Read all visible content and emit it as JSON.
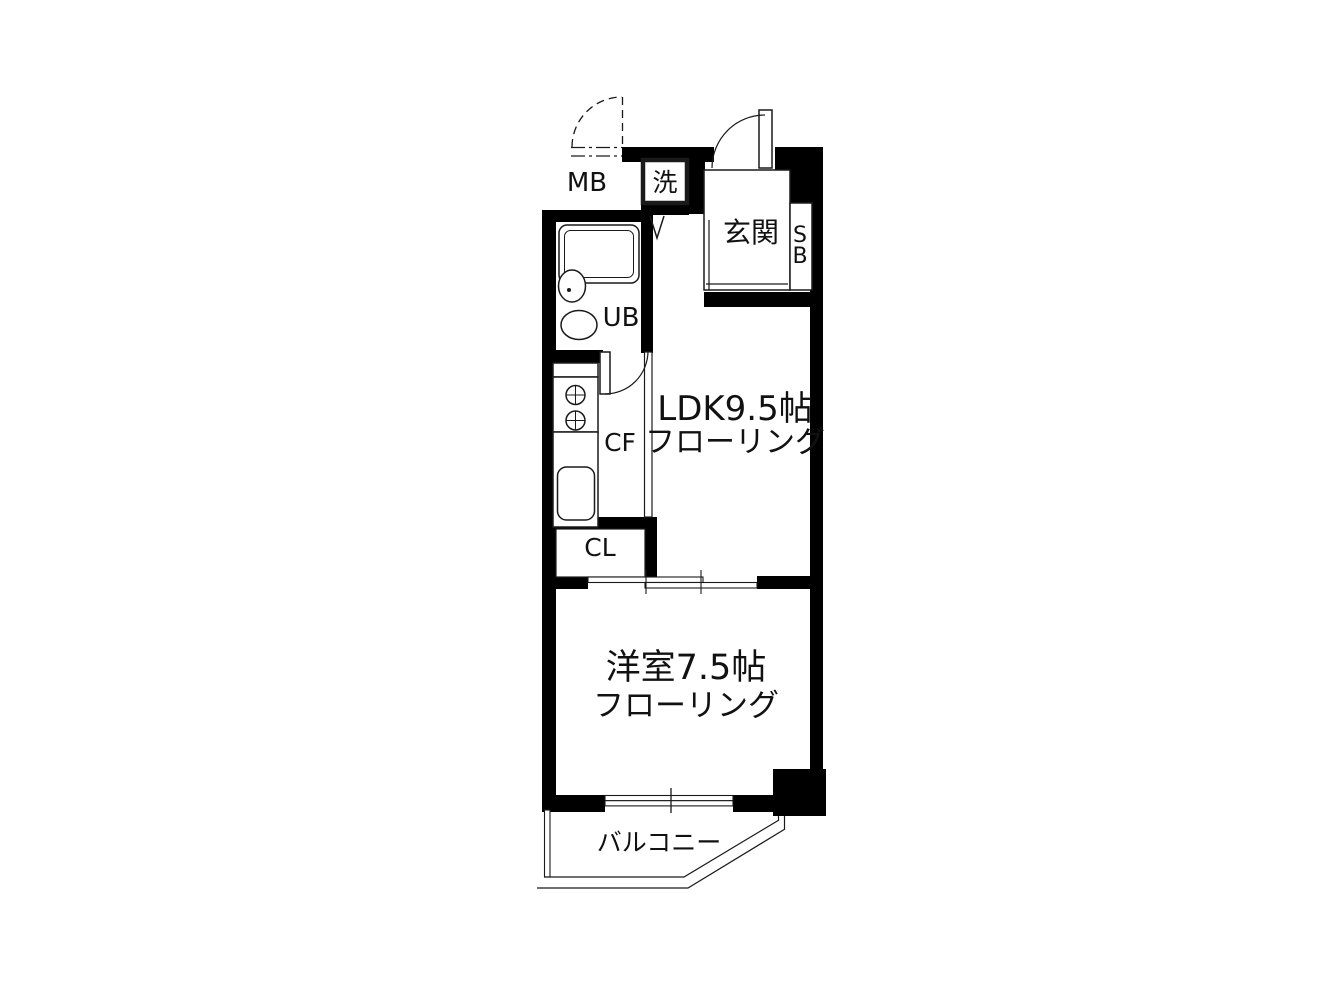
{
  "title": "間取り図 (apartment floor plan)",
  "colors": {
    "background": "#ffffff",
    "wall": "#000000",
    "line": "#1a1a1a",
    "text": "#111111"
  },
  "rooms": {
    "ldk": {
      "name": "LDK9.5帖",
      "flooring": "フローリング"
    },
    "western_room": {
      "name": "洋室7.5帖",
      "flooring": "フローリング"
    },
    "entrance": {
      "label": "玄関"
    },
    "balcony": {
      "label": "バルコニー"
    },
    "unit_bath": {
      "label": "UB"
    },
    "kitchen": {
      "label": "CF"
    },
    "closet": {
      "label": "CL"
    },
    "washer": {
      "label": "洗"
    },
    "meter_box": {
      "label": "MB"
    },
    "shoe_box": {
      "line1": "S",
      "line2": "B"
    }
  }
}
